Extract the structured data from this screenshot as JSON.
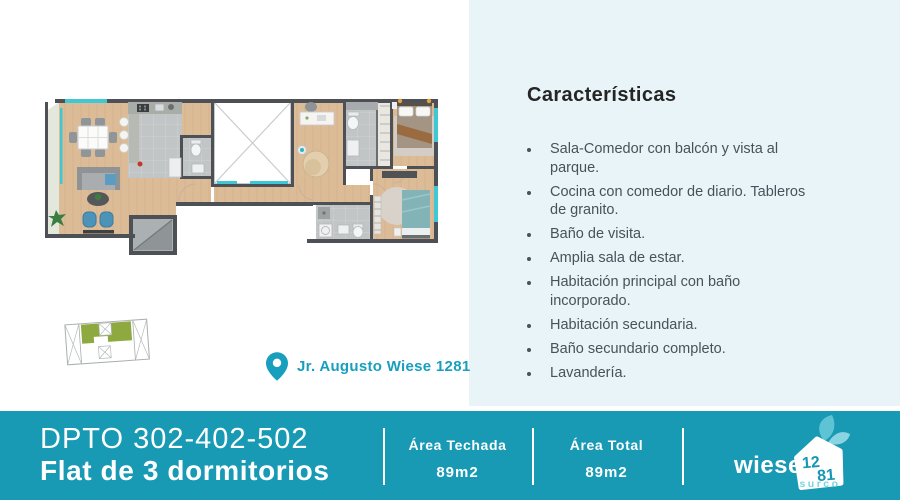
{
  "colors": {
    "accent_teal": "#1899b4",
    "light_teal": "#6fcbdd",
    "panel_blue": "#e9f4f8",
    "address_teal": "#189fbe",
    "keyplan_green": "#8da93f",
    "window_teal": "#3fc8d4"
  },
  "icons": {
    "location_pin": "map-pin",
    "brand_house": "house-with-number",
    "brand_leaves": "leaf"
  },
  "location": {
    "address": "Jr. Augusto Wiese 1281"
  },
  "features": {
    "title": "Características",
    "items": [
      "Sala-Comedor con balcón y vista al parque.",
      "Cocina con comedor de diario. Tableros de granito.",
      "Baño de visita.",
      "Amplia sala de estar.",
      "Habitación principal con baño incorporado.",
      "Habitación secundaria.",
      "Baño secundario completo.",
      "Lavandería."
    ]
  },
  "footer": {
    "unit_number": "DPTO 302-402-502",
    "unit_type": "Flat de 3 dormitorios",
    "areas": [
      {
        "label": "Área Techada",
        "value": "89m2"
      },
      {
        "label": "Área Total",
        "value": "89m2"
      }
    ],
    "brand": {
      "name": "wiese",
      "number_top": "12",
      "number_bottom": "81",
      "district": "surco"
    }
  }
}
